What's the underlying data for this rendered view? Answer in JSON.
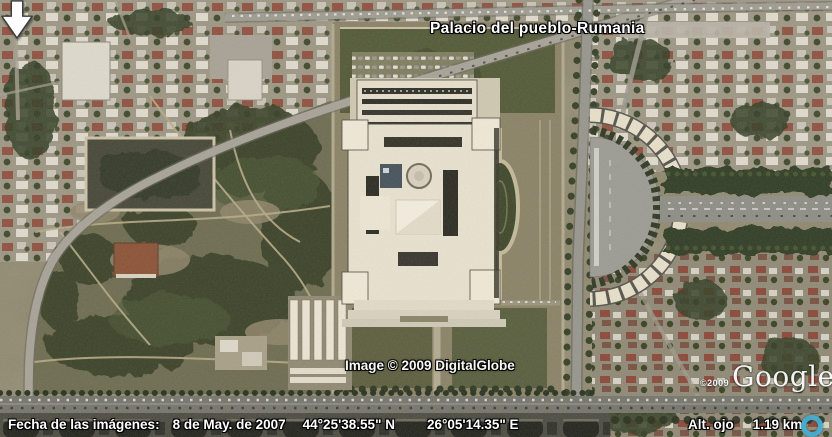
{
  "map": {
    "placemark_label": "Palacio del pueblo-Rumania"
  },
  "watermarks": {
    "imagery_credit": "Image © 2009 DigitalGlobe",
    "logo_copyright": "©2009",
    "logo_text": "Google",
    "logo_tm": "™"
  },
  "status_bar": {
    "date_label": "Fecha de las imágenes:",
    "date_value": "8 de May. de 2007",
    "latitude": "44°25'38.55\" N",
    "longitude": "26°05'14.35\" E",
    "eye_alt_label": "Alt. ojo",
    "eye_alt_value": "1.19 km"
  },
  "icons": {
    "placemark_arrow": "⬇",
    "navigation_ring": "◎"
  },
  "colors": {
    "overlay_text": "#ffffff",
    "overlay_outline": "#000000",
    "nav_ring_accent": "#45aed0",
    "ground_olive": "#8d8569",
    "park_green": "#6c6a4d",
    "tree_dark": "#343d22",
    "palace_cream": "#e9e2cf",
    "road_gray": "#a7a296",
    "plaza_gray": "#9b9b93"
  }
}
